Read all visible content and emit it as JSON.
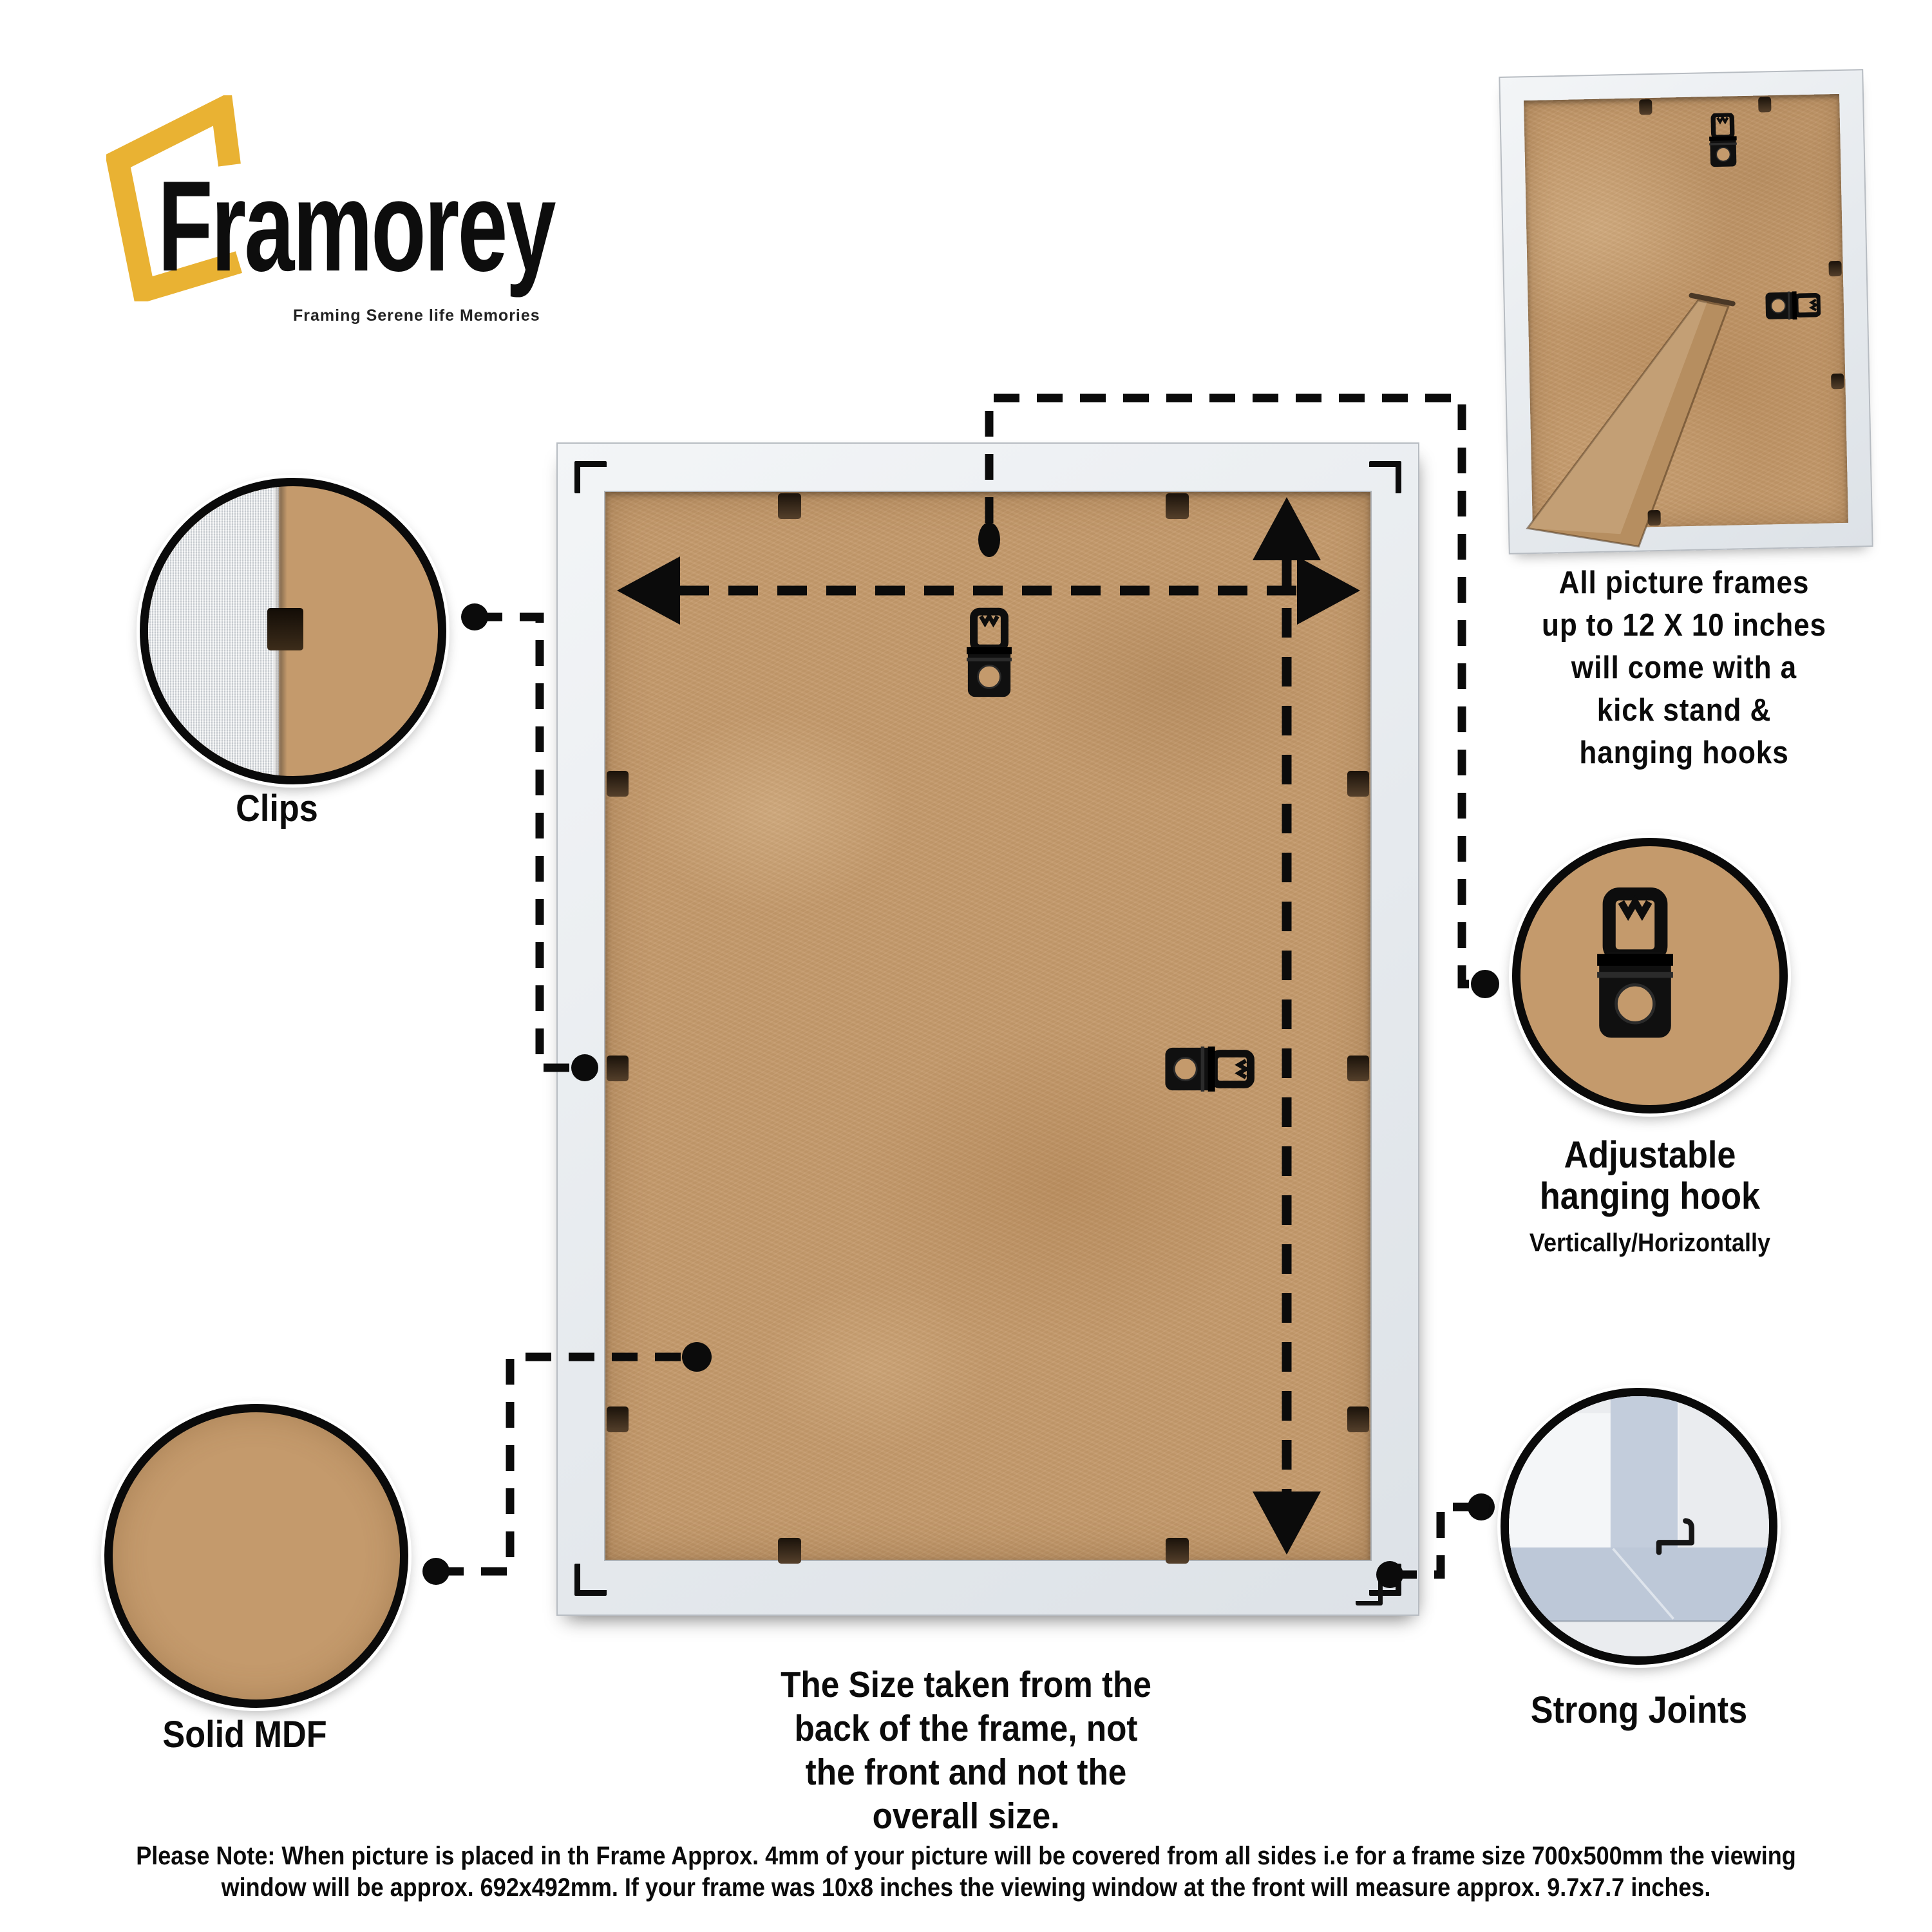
{
  "brand": {
    "name": "Framorey",
    "tagline": "Framing Serene life Memories",
    "accent_color": "#E9B233"
  },
  "inset_caption": {
    "lines": [
      "All picture frames",
      "up to 12 X 10 inches",
      "will come with a",
      "kick stand &",
      "hanging hooks"
    ]
  },
  "labels": {
    "clips": "Clips",
    "solid_mdf": "Solid MDF",
    "hanging_hook_line1": "Adjustable",
    "hanging_hook_line2": "hanging hook",
    "hanging_hook_sub": "Vertically/Horizontally",
    "strong_joints": "Strong Joints"
  },
  "size_note": {
    "lines": [
      "The Size taken from the",
      "back of the frame, not",
      "the front and not the",
      "overall size."
    ]
  },
  "footer_note": {
    "lines": [
      "Please Note: When picture is placed in th Frame Approx. 4mm of your picture will be covered from all sides i.e for a frame size 700x500mm the viewing",
      "window will be approx. 692x492mm. If your frame was 10x8 inches the viewing window at the front will measure approx. 9.7x7.7 inches."
    ]
  },
  "colors": {
    "mdf": "#C49A6C",
    "frame_border": "#E7EAED",
    "joint_blue": "#BDC8D8",
    "accent_yellow": "#E9B233",
    "line_black": "#0b0b0b"
  }
}
